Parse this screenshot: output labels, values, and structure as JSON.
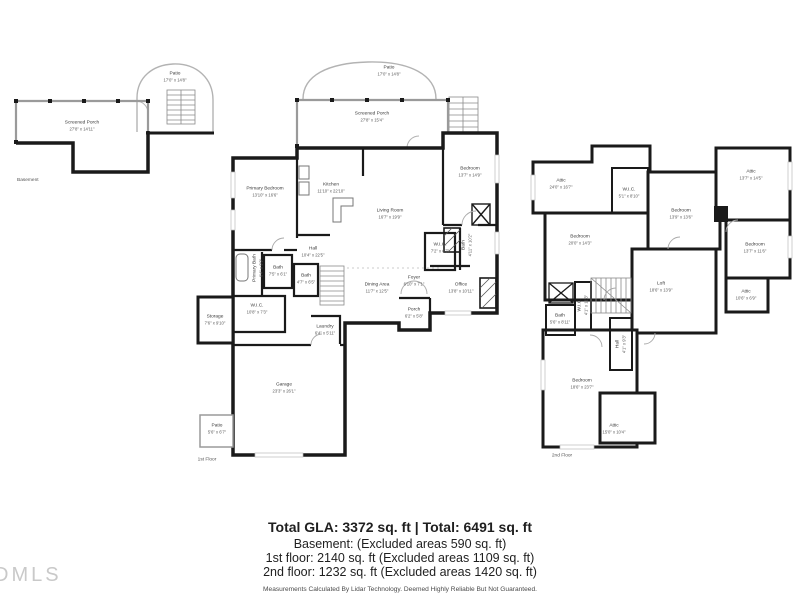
{
  "colors": {
    "wall": "#1a1a1a",
    "screen_wall": "#9a9a9a",
    "label_text": "#3a3a3a",
    "watermark": "#c9c9c9"
  },
  "watermark": "DMLS",
  "floors": {
    "basement": {
      "label": "Basement",
      "rooms": [
        {
          "name": "Patio",
          "dims": "17'0\" x 14'8\""
        },
        {
          "name": "Screened Porch",
          "dims": "27'8\" x 14'11\""
        }
      ]
    },
    "first": {
      "label": "1st Floor",
      "rooms": [
        {
          "name": "Patio",
          "dims": "17'0\" x 14'8\""
        },
        {
          "name": "Screened Porch",
          "dims": "27'8\" x 15'4\""
        },
        {
          "name": "Kitchen",
          "dims": "11'10\" x 22'10\""
        },
        {
          "name": "Primary Bedroom",
          "dims": "13'10\" x 16'6\""
        },
        {
          "name": "Bedroom",
          "dims": "13'7\" x 14'9\""
        },
        {
          "name": "Living Room",
          "dims": "16'7\" x 19'9\""
        },
        {
          "name": "Hall",
          "dims": "10'4\" x 22'5\""
        },
        {
          "name": "Primary Bath",
          "dims": "6'4\" x 9'9\""
        },
        {
          "name": "Bath",
          "dims": "7'5\" x 6'1\""
        },
        {
          "name": "Bath",
          "dims": "4'7\" x 6'5\""
        },
        {
          "name": "W.I.C.",
          "dims": "7'2\" x 6'7\""
        },
        {
          "name": "Bath",
          "dims": "4'11\" x 10'2\""
        },
        {
          "name": "W.I.C.",
          "dims": "10'8\" x 7'3\""
        },
        {
          "name": "Storage",
          "dims": "7'6\" x 9'10\""
        },
        {
          "name": "Laundry",
          "dims": "6'4\" x 5'11\""
        },
        {
          "name": "Dining Area",
          "dims": "11'7\" x 12'5\""
        },
        {
          "name": "Foyer",
          "dims": "6'10\" x 7'1\""
        },
        {
          "name": "Porch",
          "dims": "6'2\" x 5'8\""
        },
        {
          "name": "Office",
          "dims": "13'8\" x 10'11\""
        },
        {
          "name": "Garage",
          "dims": "23'3\" x 26'1\""
        },
        {
          "name": "Patio",
          "dims": "5'6\" x 6'7\""
        }
      ]
    },
    "second": {
      "label": "2nd Floor",
      "rooms": [
        {
          "name": "Attic",
          "dims": "24'0\" x 16'7\""
        },
        {
          "name": "W.I.C.",
          "dims": "5'1\" x 8'10\""
        },
        {
          "name": "Bedroom",
          "dims": "20'0\" x 14'3\""
        },
        {
          "name": "Bedroom",
          "dims": "13'9\" x 13'6\""
        },
        {
          "name": "Attic",
          "dims": "13'7\" x 14'5\""
        },
        {
          "name": "Bedroom",
          "dims": "13'7\" x 11'6\""
        },
        {
          "name": "Attic",
          "dims": "10'6\" x 6'9\""
        },
        {
          "name": "Loft",
          "dims": "18'6\" x 13'9\""
        },
        {
          "name": "Bath",
          "dims": "5'6\" x 8'11\""
        },
        {
          "name": "W.I.C.",
          "dims": "4'1\" x 11'3\""
        },
        {
          "name": "Hall",
          "dims": "4'1\" x 9'3\""
        },
        {
          "name": "Bedroom",
          "dims": "18'6\" x 23'7\""
        },
        {
          "name": "Attic",
          "dims": "15'0\" x 10'4\""
        }
      ]
    }
  },
  "summary": {
    "line1": "Total GLA: 3372 sq. ft | Total: 6491 sq. ft",
    "line2": "Basement: (Excluded areas 590 sq. ft)",
    "line3": "1st floor: 2140 sq. ft (Excluded areas 1109 sq. ft)",
    "line4": "2nd floor: 1232 sq. ft (Excluded areas 1420 sq. ft)",
    "disclaimer": "Measurements Calculated By Lidar Technology. Deemed Highly Reliable But Not Guaranteed."
  }
}
